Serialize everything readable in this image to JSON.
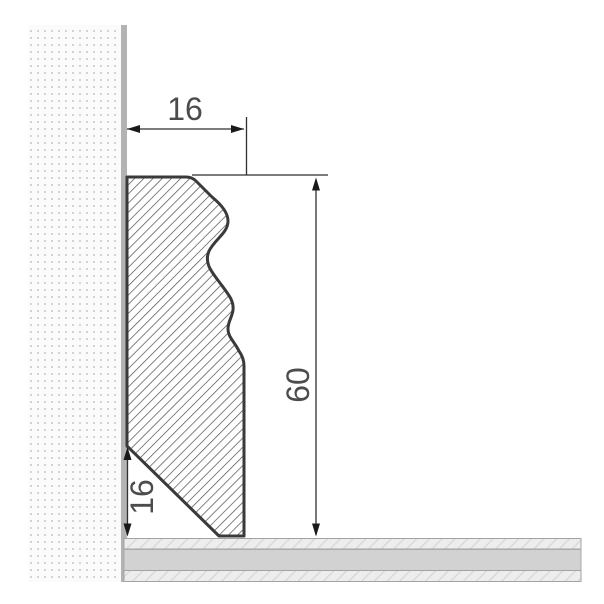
{
  "title": "Skirting board profile cross-section drawing",
  "dimensions": {
    "top_width": "16",
    "height": "60",
    "bottom_bevel": "16"
  },
  "colors": {
    "profile_outline": "#3a3a3a",
    "profile_hatch_line": "#4d4d4d",
    "wall_face": "#b3b3b3",
    "wall_dot": "#d3d3d3",
    "wall_bg": "#fbfbfb",
    "floor_gray": "#d2d2d2",
    "floor_hatch_bg": "#ededed",
    "floor_hatch_line": "#d7d7d7",
    "floor_border": "#a3a3a3",
    "dim_line": "#2f2f2f",
    "dim_text": "#4c4c4c"
  }
}
